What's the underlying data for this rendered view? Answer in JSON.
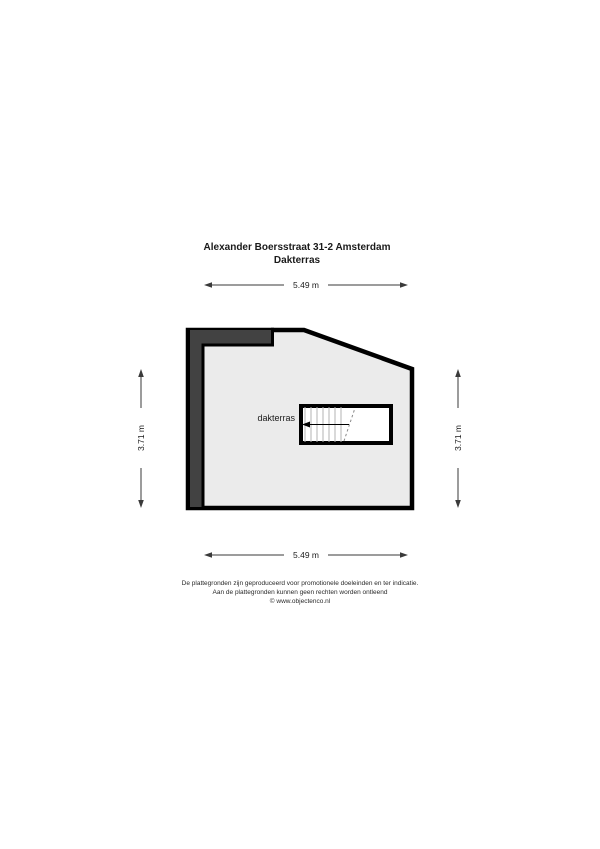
{
  "title": {
    "line1": "Alexander Boersstraat 31-2 Amsterdam",
    "line2": "Dakterras"
  },
  "floorplan": {
    "room_label": "dakterras",
    "dimensions": {
      "width_top": "5.49 m",
      "width_bottom": "5.49 m",
      "height_left": "3.71 m",
      "height_right": "3.71 m"
    }
  },
  "footer": {
    "lines": [
      "De plattegronden zijn geproduceerd voor promotionele doeleinden en ter indicatie.",
      "Aan de plattegronden kunnen geen rechten worden ontleend",
      "© www.objectenco.nl"
    ]
  },
  "colors": {
    "wall": "#000000",
    "wall_band": "#424242",
    "floor": "#ebebeb",
    "stairs_fill": "#ffffff",
    "dimension_line": "#3a3a3a",
    "text": "#1a1a1a",
    "background": "#ffffff"
  }
}
